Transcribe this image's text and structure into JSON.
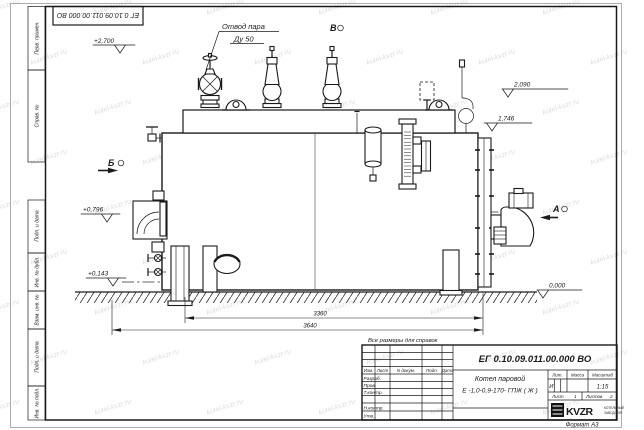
{
  "sheet": {
    "format_label": "Формат А3",
    "note": "Все размеры для справок",
    "watermark": "kotel-kvzr.ru"
  },
  "stamp_top": {
    "doc_number": "ЕГ 0.10.09.011.00.000  ВО"
  },
  "margin_cells": [
    "Перв. примен.",
    "Справ. №",
    "Подп. и дата",
    "Инв. № дубл.",
    "Взам. инв. №",
    "Подп. и дата",
    "Инв. № подл."
  ],
  "title_block": {
    "doc_number": "ЕГ 0.10.09.011.00.000  ВО",
    "product_name_line1": "Котел паровой",
    "product_name_line2": "Е -1,0-0,9-170- ГПЖ ( Ж )",
    "col_izm": "Изм.",
    "col_list": "Лист",
    "col_ndokum": "N докум.",
    "col_podp": "Подп.",
    "col_data": "Дата",
    "row_razrab": "Разраб.",
    "row_prov": "Пров.",
    "row_tkontr": "Т.контр.",
    "row_nkontr": "Н.контр.",
    "row_utv": "Утв.",
    "lit_label": "Лит.",
    "mass_label": "Масса",
    "scale_label": "Масштаб",
    "lit_value": "И",
    "scale_value": "1:15",
    "sheet_label": "Лист",
    "sheet_value": "1",
    "sheets_label": "Листов",
    "sheets_value": "2",
    "logo_text": "KVZR",
    "logo_sub1": "КОТЕЛЬНЫЙ",
    "logo_sub2": "ЗАВОД РЭП"
  },
  "annotations": {
    "steam_outlet_line1": "Отвод пара",
    "steam_outlet_line2": "Ду 50",
    "view_a": "А",
    "view_b": "Б",
    "view_v": "В",
    "elevations": {
      "e2700": "+2,700",
      "e2090": "2,090",
      "e1746": "1,746",
      "e0796": "+0,796",
      "e0143": "+0,143",
      "e0000": "0,000"
    },
    "dims": {
      "d3360": "3360",
      "d3640": "3640"
    }
  }
}
